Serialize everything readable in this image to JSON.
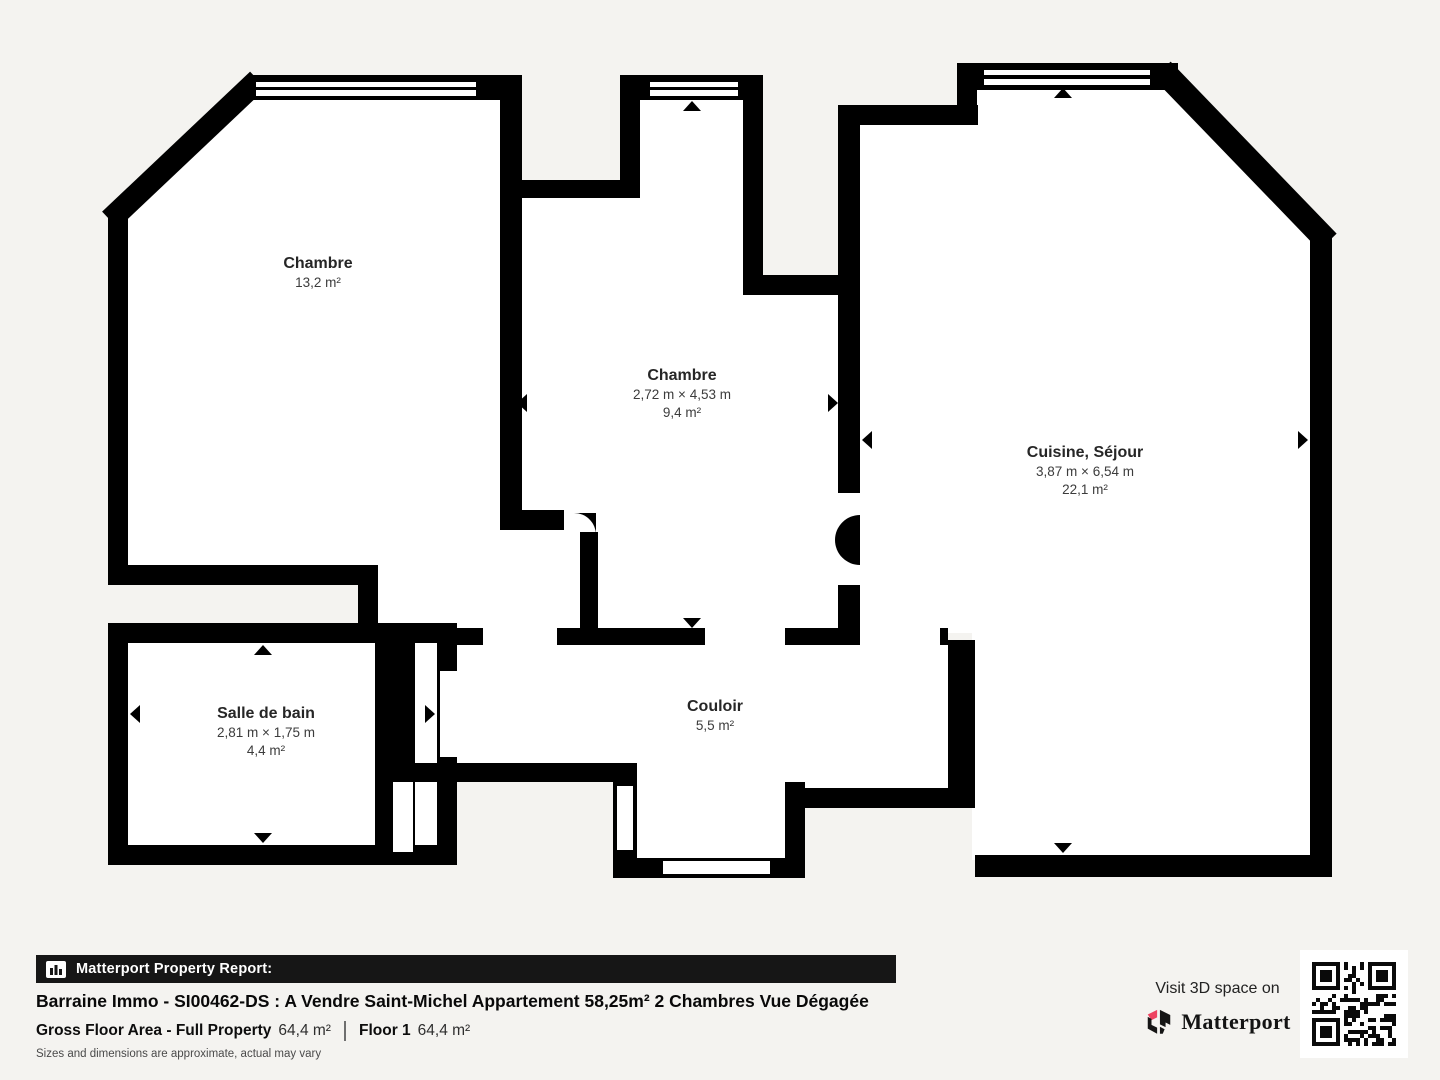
{
  "plan": {
    "rooms": [
      {
        "id": "chambre-1",
        "name": "Chambre",
        "area": "13,2 m²"
      },
      {
        "id": "chambre-2",
        "name": "Chambre",
        "dims": "2,72 m × 4,53 m",
        "area": "9,4 m²"
      },
      {
        "id": "cuisine-sejour",
        "name": "Cuisine, Séjour",
        "dims": "3,87 m × 6,54 m",
        "area": "22,1 m²"
      },
      {
        "id": "salle-de-bain",
        "name": "Salle de bain",
        "dims": "2,81 m × 1,75 m",
        "area": "4,4 m²"
      },
      {
        "id": "couloir",
        "name": "Couloir",
        "area": "5,5 m²"
      }
    ],
    "colors": {
      "wall": "#000000",
      "interior": "#ffffff",
      "background": "#f4f3f0"
    }
  },
  "footer": {
    "report_bar_label": "Matterport Property Report:",
    "title": "Barraine Immo - SI00462-DS : A Vendre Saint-Michel Appartement 58,25m² 2 Chambres Vue Dégagée",
    "gross_label": "Gross Floor Area - Full Property",
    "gross_value": "64,4 m²",
    "floor_label": "Floor 1",
    "floor_value": "64,4 m²",
    "disclaimer": "Sizes and dimensions are approximate, actual may vary",
    "visit_text": "Visit 3D space on",
    "brand": "Matterport",
    "brand_accent": "#ee4360"
  }
}
